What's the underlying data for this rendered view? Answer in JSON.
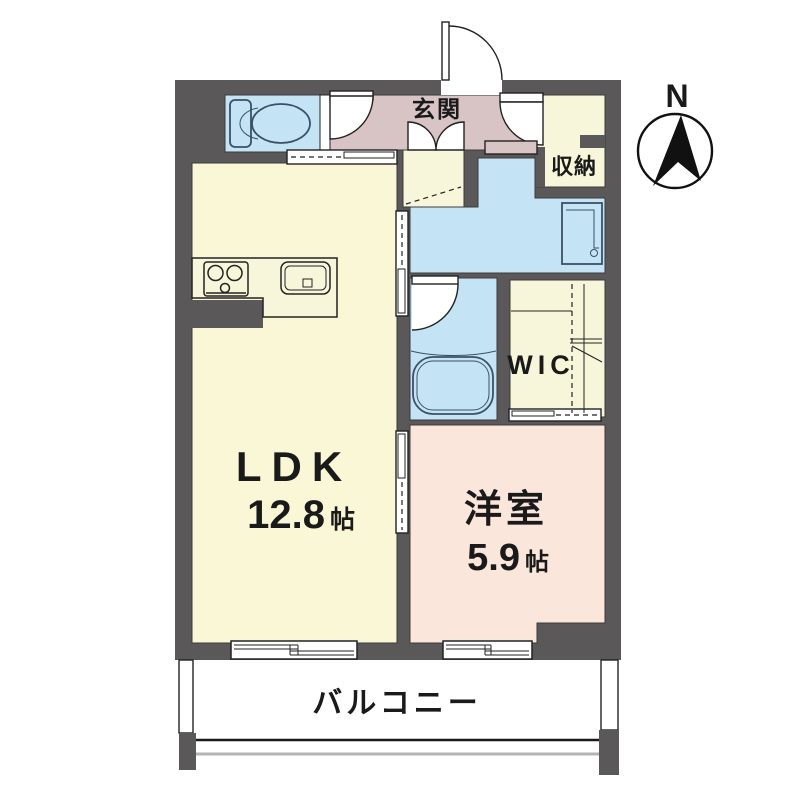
{
  "compass": {
    "north_label": "N"
  },
  "rooms": {
    "ldk": {
      "name": "LDK",
      "size_value": "12.8",
      "size_unit": "帖"
    },
    "western_room": {
      "name": "洋室",
      "size_value": "5.9",
      "size_unit": "帖"
    },
    "entrance": {
      "name": "玄関"
    },
    "storage": {
      "name": "収納"
    },
    "wic": {
      "name": "WIC"
    },
    "balcony": {
      "name": "バルコニー"
    }
  },
  "colors": {
    "wall": "#5a5858",
    "ldk": "#f9f7d6",
    "western": "#fae6da",
    "hallway": "#d8c4c4",
    "water": "#c4e4f5",
    "cream": "#f8f6da",
    "fixture": "#3a5068",
    "railing": "#b4b4b4"
  }
}
